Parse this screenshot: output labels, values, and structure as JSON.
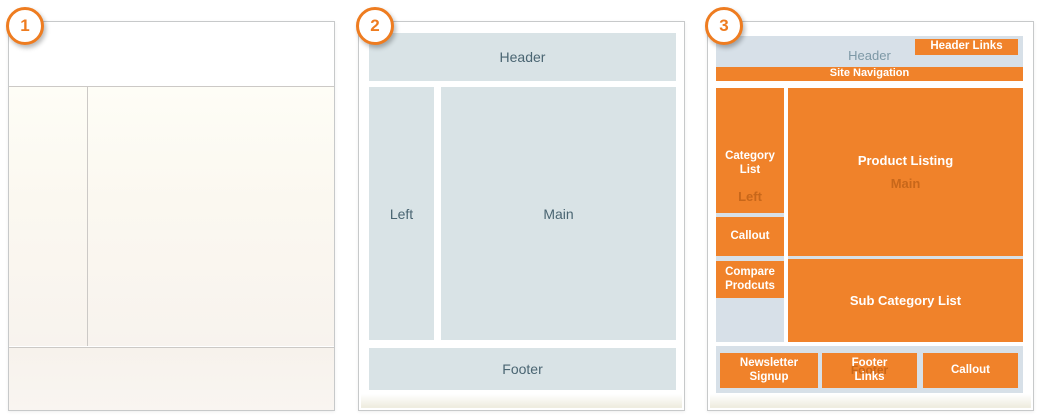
{
  "colors": {
    "accent_orange": "#F0822A",
    "badge_orange": "#EE7C20",
    "panel2_box_blue": "#D9E3E6",
    "panel3_box_blue": "#D7E0E8",
    "label_slate": "#4A6572",
    "ghost_blue_text": "#7D98A6",
    "panel_border_gray": "#C7C9CA"
  },
  "panels": [
    {
      "badge": "1"
    },
    {
      "badge": "2",
      "labels": {
        "header": "Header",
        "left": "Left",
        "main": "Main",
        "footer": "Footer"
      }
    },
    {
      "badge": "3",
      "ghosts": {
        "header": "Header",
        "left": "Left",
        "main": "Main",
        "footer": "Footer"
      },
      "blocks": {
        "header_links": "Header Links",
        "site_navigation": "Site Navigation",
        "category_list": "Category List",
        "callout_left": "Callout",
        "compare_products": "Compare Prodcuts",
        "product_listing": "Product Listing",
        "sub_category_list": "Sub Category List",
        "newsletter_signup": "Newsletter Signup",
        "footer_links": "Footer Links",
        "callout_footer": "Callout"
      }
    }
  ]
}
